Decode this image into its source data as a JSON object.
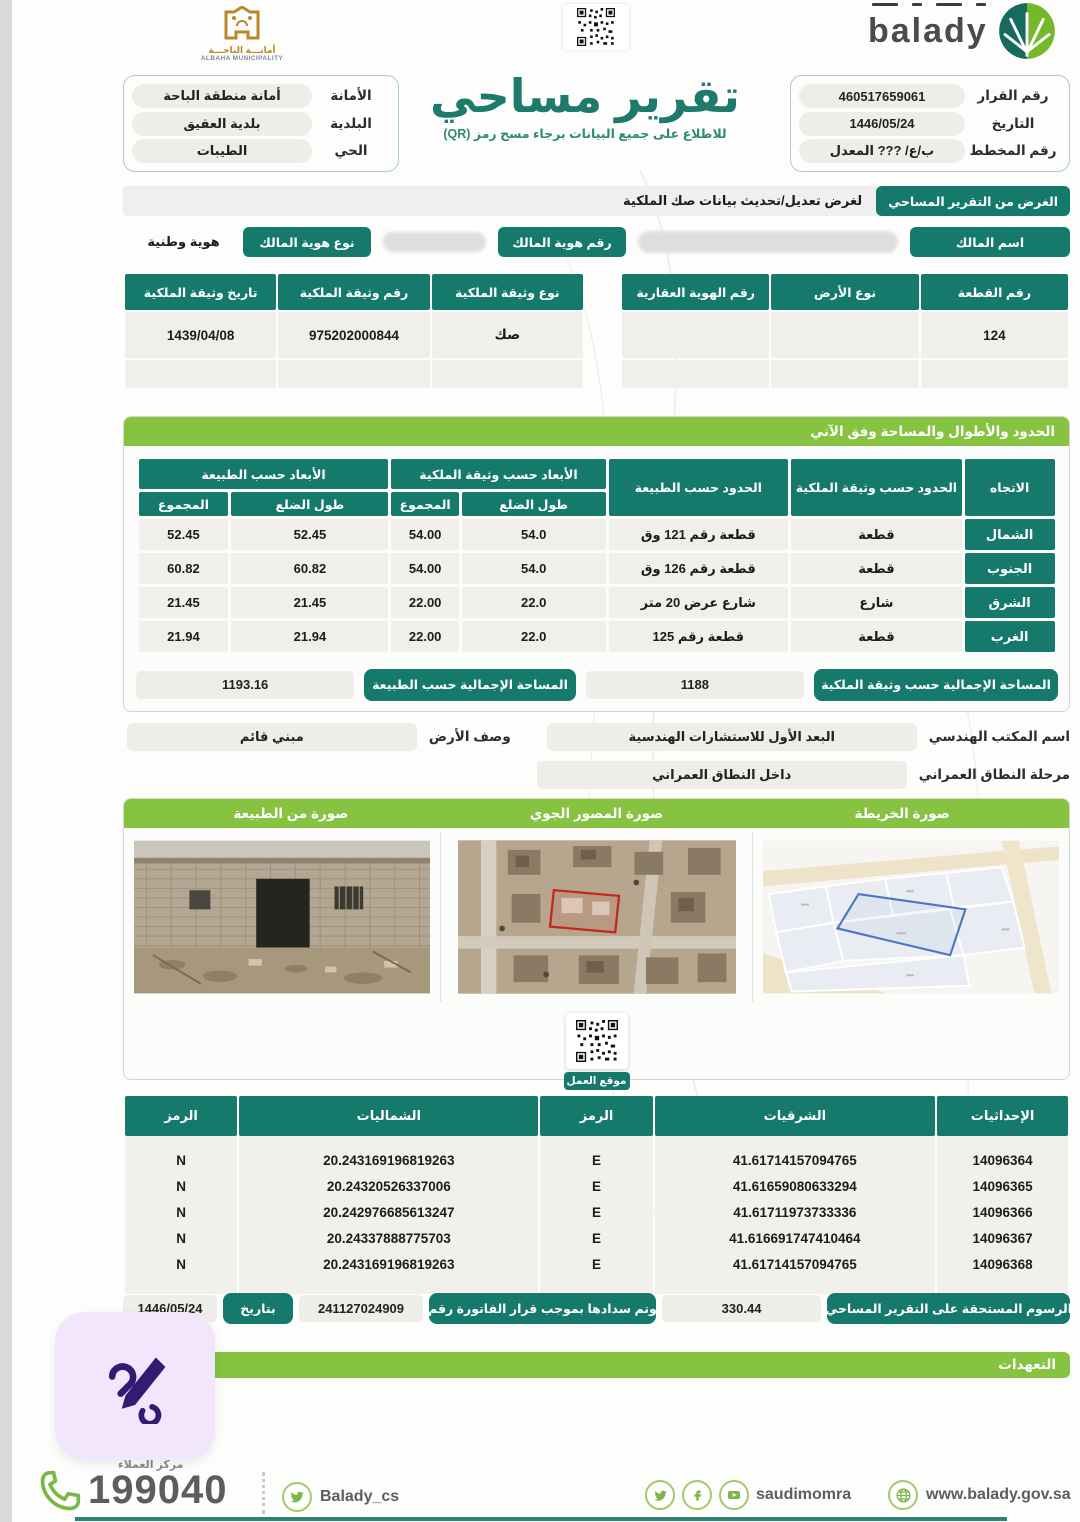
{
  "header": {
    "municipality_logo": {
      "arabic": "أمانـــة الباحـــة",
      "english": "ALBAHA MUNICIPALITY"
    },
    "balady_wordmark": "balady",
    "title": "تقرير مساحي",
    "subtitle": "للاطلاع على جميع البيانات برجاء مسح رمز (QR)",
    "right_info": [
      {
        "label": "رقم القرار",
        "value": "460517659061"
      },
      {
        "label": "التاريخ",
        "value": "1446/05/24"
      },
      {
        "label": "رقم المخطط",
        "value": "ب/ع/ ??? المعدل"
      }
    ],
    "left_info": [
      {
        "label": "الأمانة",
        "value": "أمانة منطقة الباحة"
      },
      {
        "label": "البلدية",
        "value": "بلدية العقيق"
      },
      {
        "label": "الحي",
        "value": "الطيبات"
      }
    ]
  },
  "purpose": {
    "label": "الغرض من التقرير المساحي",
    "value": "لغرض تعديل/تحديث بيانات صك الملكية"
  },
  "owner": {
    "name_label": "اسم المالك",
    "name_value": "",
    "id_label": "رقم هوية المالك",
    "id_value": "",
    "id_type_label": "نوع هوية المالك",
    "id_type_value": "هوية وطنية"
  },
  "parcel_table": {
    "headers": [
      "رقم القطعة",
      "نوع الأرض",
      "رقم الهوية العقارية"
    ],
    "rows": [
      [
        "124",
        "",
        ""
      ],
      [
        "",
        "",
        ""
      ]
    ]
  },
  "deed_table": {
    "headers": [
      "نوع وثيقة الملكية",
      "رقم وثيقة الملكية",
      "تاريخ وثيقة الملكية"
    ],
    "rows": [
      [
        "صك",
        "975202000844",
        "1439/04/08"
      ],
      [
        "",
        "",
        ""
      ]
    ]
  },
  "boundaries": {
    "title": "الحدود والأطوال والمساحة وفق الآتي",
    "col_direction": "الاتجاه",
    "col_bounds_deed": "الحدود حسب وثيقة الملكية",
    "col_bounds_nature": "الحدود حسب الطبيعة",
    "col_dims_deed": "الأبعاد حسب وثيقة الملكية",
    "col_dims_nature": "الأبعاد حسب الطبيعة",
    "col_side": "طول الضلع",
    "col_total": "المجموع",
    "rows": [
      {
        "direction": "الشمال",
        "bound_deed": "قطعة",
        "bound_nature": "قطعة رقم 121 وق",
        "deed_side": "54.0",
        "deed_total": "54.00",
        "nature_side": "52.45",
        "nature_total": "52.45"
      },
      {
        "direction": "الجنوب",
        "bound_deed": "قطعة",
        "bound_nature": "قطعة رقم 126 وق",
        "deed_side": "54.0",
        "deed_total": "54.00",
        "nature_side": "60.82",
        "nature_total": "60.82"
      },
      {
        "direction": "الشرق",
        "bound_deed": "شارع",
        "bound_nature": "شارع عرض 20 متر",
        "deed_side": "22.0",
        "deed_total": "22.00",
        "nature_side": "21.45",
        "nature_total": "21.45"
      },
      {
        "direction": "الغرب",
        "bound_deed": "قطعة",
        "bound_nature": "قطعة رقم 125",
        "deed_side": "22.0",
        "deed_total": "22.00",
        "nature_side": "21.94",
        "nature_total": "21.94"
      }
    ],
    "total_deed_label": "المساحة الإجمالية حسب وثيقة الملكية",
    "total_deed_value": "1188",
    "total_nature_label": "المساحة الإجمالية حسب الطبيعة",
    "total_nature_value": "1193.16"
  },
  "office": {
    "office_label": "اسم المكتب الهندسي",
    "office_value": "البعد الأول للاستشارات الهندسية",
    "land_desc_label": "وصف الأرض",
    "land_desc_value": "مبني قائم",
    "scope_label": "مرحلة النطاق العمراني",
    "scope_value": "داخل النطاق العمراني"
  },
  "images": {
    "map_title": "صورة الخريطة",
    "aerial_title": "صورة المصور الجوي",
    "nature_title": "صورة من الطبيعة",
    "qr_label": "موقع العمل"
  },
  "coordinates": {
    "headers": {
      "id": "الإحداثيات",
      "easting": "الشرقيات",
      "e_code": "الرمز",
      "northing": "الشماليات",
      "n_code": "الرمز"
    },
    "rows": [
      {
        "id": "14096364",
        "easting": "41.61714157094765",
        "e": "E",
        "northing": "20.243169196819263",
        "n": "N"
      },
      {
        "id": "14096365",
        "easting": "41.61659080633294",
        "e": "E",
        "northing": "20.24320526337006",
        "n": "N"
      },
      {
        "id": "14096366",
        "easting": "41.61711973733336",
        "e": "E",
        "northing": "20.242976685613247",
        "n": "N"
      },
      {
        "id": "14096367",
        "easting": "41.616691747410464",
        "e": "E",
        "northing": "20.24337888775703",
        "n": "N"
      },
      {
        "id": "14096368",
        "easting": "41.61714157094765",
        "e": "E",
        "northing": "20.243169196819263",
        "n": "N"
      }
    ]
  },
  "fees": {
    "label": "الرسوم المستحقة على التقرير المساحي",
    "amount": "330.44",
    "invoice_label": "وتم سدادها بموجب قرار الفاتورة رقم",
    "invoice_number": "241127024909",
    "date_label": "بتاريخ",
    "date_value": "1446/05/24"
  },
  "pledges": {
    "title": "التعهدات"
  },
  "footer": {
    "call_center_label": "مركز العملاء",
    "phone": "199040",
    "twitter_handle": "Balady_cs",
    "social_handle": "saudimomra",
    "website": "www.balady.gov.sa"
  },
  "colors": {
    "teal": "#15796c",
    "green": "#85c341",
    "purple": "#321b70"
  }
}
